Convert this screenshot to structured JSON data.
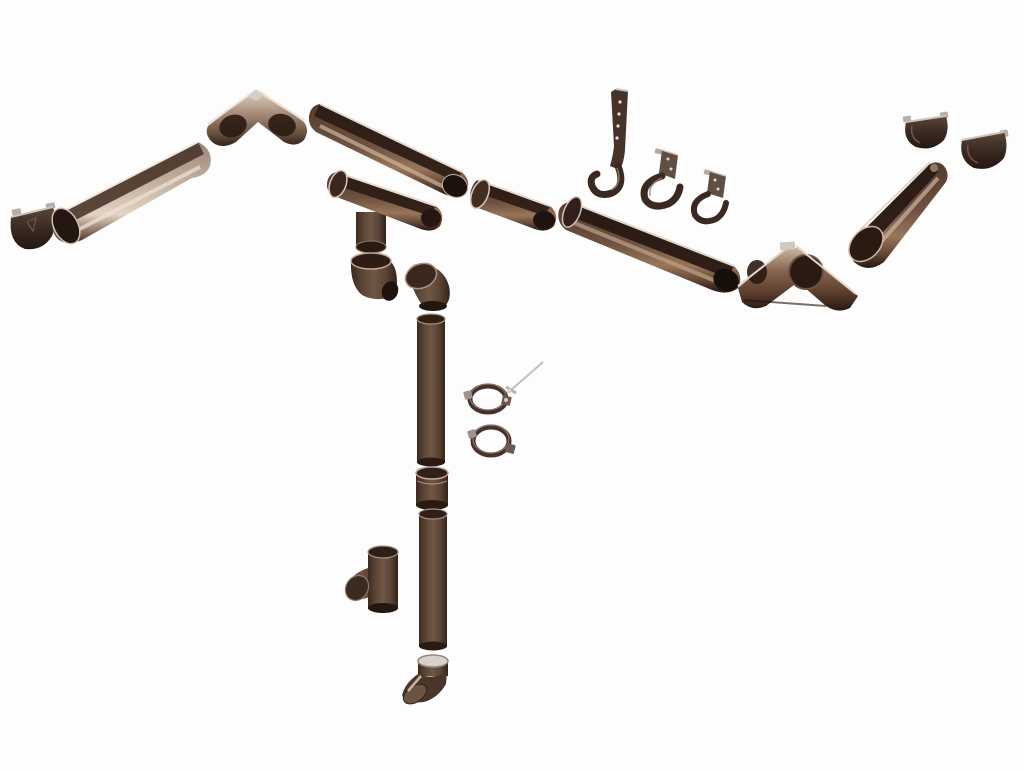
{
  "image": {
    "description": "Exploded product view of a brown metal rain gutter system: gutter sections, corners, end caps, hooks, downpipes, elbows, clamps and fittings on a white background",
    "background": "#fdfdfd"
  },
  "palette": {
    "body_brown": "#5a443a",
    "chocolate": "#4a3326",
    "taupe_light": "#c8b5a5",
    "rim_highlight": "#ece4dc",
    "inner_shadow": "#2a1a12",
    "deep_shadow": "#1c110b",
    "metal_gray": "#b8b4b1",
    "background": "#fdfdfd"
  },
  "parts": [
    {
      "id": "end-cap-left",
      "label": "Gutter end cap (left)"
    },
    {
      "id": "gutter-section-left",
      "label": "Gutter section"
    },
    {
      "id": "inside-corner",
      "label": "Gutter inside corner 90°"
    },
    {
      "id": "gutter-section-middle",
      "label": "Gutter section"
    },
    {
      "id": "running-outlet",
      "label": "Gutter running outlet (funnel)"
    },
    {
      "id": "gutter-section-short",
      "label": "Gutter connector section"
    },
    {
      "id": "elbow-left",
      "label": "Downpipe elbow"
    },
    {
      "id": "elbow-right",
      "label": "Downpipe elbow"
    },
    {
      "id": "downpipe-upper",
      "label": "Downpipe section"
    },
    {
      "id": "fixing-screw",
      "label": "Clamp fixing screw"
    },
    {
      "id": "pipe-clamp-upper",
      "label": "Downpipe clamp"
    },
    {
      "id": "pipe-clamp-lower",
      "label": "Downpipe clamp"
    },
    {
      "id": "pipe-coupler",
      "label": "Downpipe coupler sleeve"
    },
    {
      "id": "downpipe-lower",
      "label": "Downpipe section"
    },
    {
      "id": "downpipe-tee",
      "label": "Downpipe tee branch"
    },
    {
      "id": "downpipe-shoe",
      "label": "Downpipe shoe outlet"
    },
    {
      "id": "rafter-hook",
      "label": "Long rafter gutter hook"
    },
    {
      "id": "gutter-hook-medium",
      "label": "Gutter fascia hook"
    },
    {
      "id": "gutter-hook-small",
      "label": "Gutter fascia hook"
    },
    {
      "id": "gutter-section-right",
      "label": "Gutter section"
    },
    {
      "id": "outside-corner",
      "label": "Gutter outside corner 90°"
    },
    {
      "id": "gutter-section-far-right",
      "label": "Gutter section"
    },
    {
      "id": "end-cap-right-a",
      "label": "Gutter end cap"
    },
    {
      "id": "end-cap-right-b",
      "label": "Gutter end cap"
    }
  ]
}
